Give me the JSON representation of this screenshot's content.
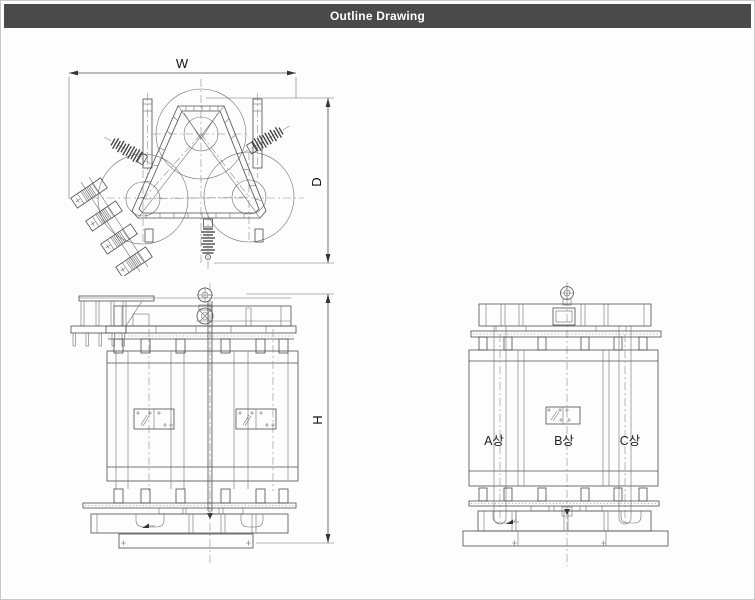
{
  "header": {
    "title": "Outline Drawing",
    "bg_color": "#4a4a4a",
    "text_color": "#ffffff"
  },
  "canvas": {
    "bg_color": "#ffffff",
    "border_color": "#c9c9c9",
    "line_color": "#4d4d4d"
  },
  "top_view": {
    "width_label": "W",
    "depth_label": "D"
  },
  "front_view": {
    "height_label": "H"
  },
  "side_view": {
    "phase_labels": [
      "A상",
      "B상",
      "C상"
    ]
  }
}
